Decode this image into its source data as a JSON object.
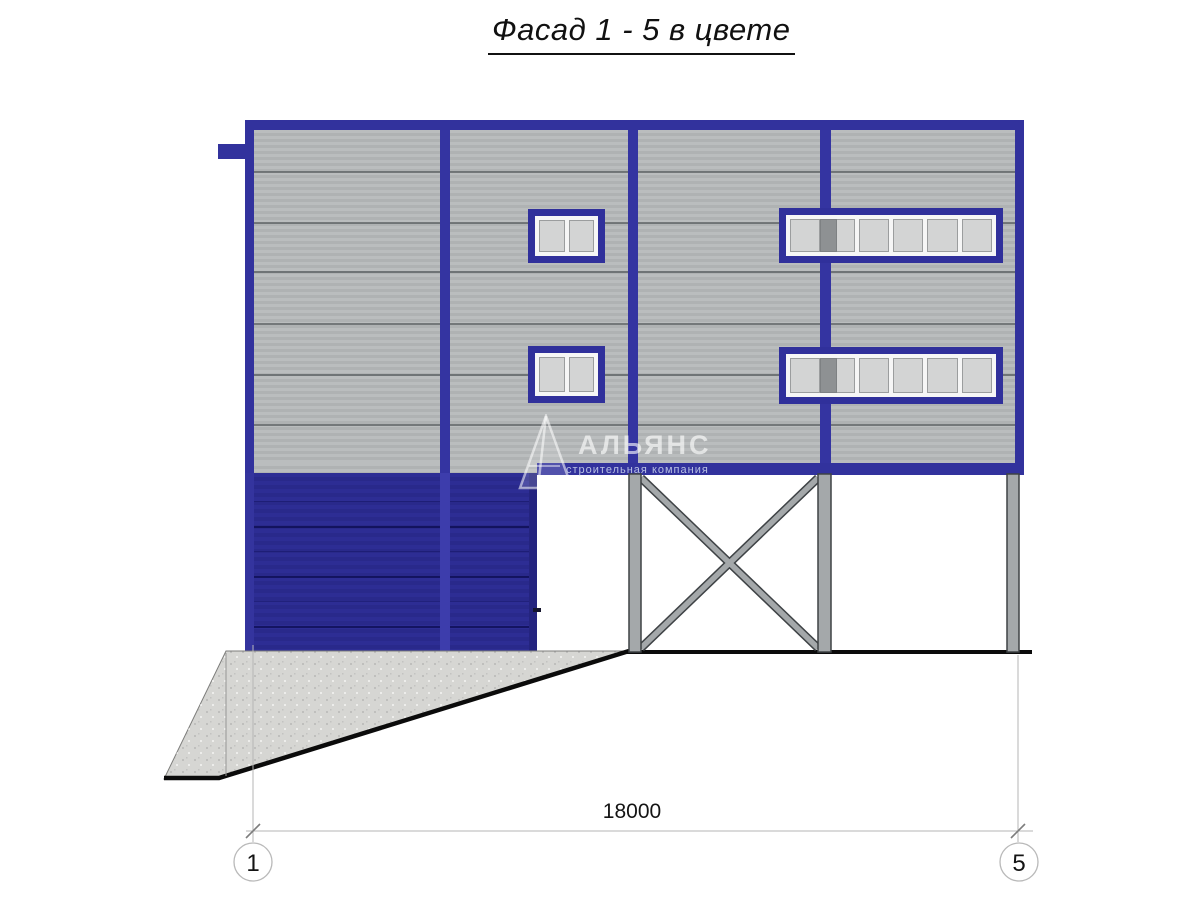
{
  "title": "Фасад 1 - 5 в цвете",
  "watermark": {
    "name": "АЛЬЯНС",
    "tagline": "строительная компания"
  },
  "dimension": {
    "value": "18000"
  },
  "axes": {
    "left": "1",
    "right": "5"
  },
  "colors": {
    "frame_navy": "#32329d",
    "garage_navy": "#2b2b8f",
    "facade_gray": "#b4b7b8",
    "panel_joint": "#5f6466",
    "window_pane": "#d3d4d4",
    "window_frame_inner": "#f6f6f6",
    "column_gray": "#a4a8aa",
    "concrete": "#d6d6d3",
    "ground_line": "#0b0b0b",
    "dimension_line": "#b5b5b5"
  }
}
